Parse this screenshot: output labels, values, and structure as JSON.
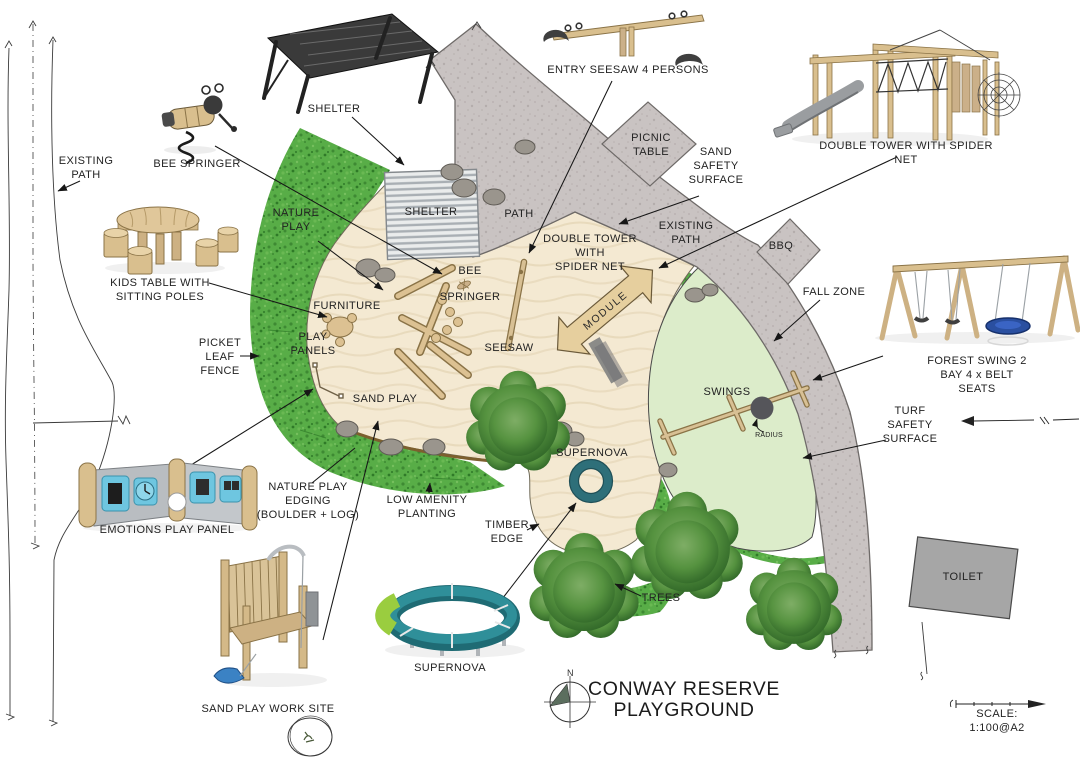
{
  "title": "CONWAY RESERVE\nPLAYGROUND",
  "compass_north": "N",
  "scale_text": "SCALE: 1:100@A2",
  "palette": {
    "sand": "#f4e9d2",
    "path_grey": "#c9c3c2",
    "turf_green": "#dcecca",
    "planting_green": "#58ad47",
    "timber_tan": "#dcc192",
    "supernova_teal": "#2e6f79",
    "toilet_grey": "#a6a6a6",
    "leader_black": "#161616"
  },
  "labels": {
    "existing_path_left": "EXISTING\nPATH",
    "bee_springer_legend": "BEE SPRINGER",
    "shelter_legend": "SHELTER",
    "entry_seesaw": "ENTRY SEESAW 4 PERSONS",
    "picnic_table": "PICNIC\nTABLE",
    "sand_safety_surface": "SAND\nSAFETY\nSURFACE",
    "double_tower_legend": "DOUBLE TOWER WITH SPIDER NET",
    "nature_play": "NATURE\nPLAY",
    "shelter_plan": "SHELTER",
    "path_plan": "PATH",
    "double_tower_plan": "DOUBLE TOWER\nWITH\nSPIDER NET",
    "existing_path_plan": "EXISTING\nPATH",
    "bbq": "BBQ",
    "fall_zone": "FALL ZONE",
    "forest_swing_legend": "FOREST SWING 2 BAY 4 x BELT SEATS",
    "kids_table_legend": "KIDS TABLE WITH\nSITTING POLES",
    "furniture": "FURNITURE",
    "play_panels": "PLAY\nPANELS",
    "picket_leaf_fence": "PICKET\nLEAF\nFENCE",
    "bee_springer_plan": "BEE\nSPRINGER",
    "seesaw": "SEESAW",
    "module": "MODULE",
    "swings": "SWINGS",
    "radius": "RADIUS",
    "sand_play": "SAND PLAY",
    "turf_safety_surface": "TURF\nSAFETY\nSURFACE",
    "nature_play_edging": "NATURE PLAY\nEDGING\n(BOULDER + LOG)",
    "low_amenity_planting": "LOW AMENITY\nPLANTING",
    "supernova_plan": "SUPERNOVA",
    "timber_edge": "TIMBER\nEDGE",
    "emotions_play_panel": "EMOTIONS PLAY PANEL",
    "sand_play_work_site": "SAND PLAY WORK SITE",
    "supernova_legend": "SUPERNOVA",
    "trees": "TREES",
    "toilet": "TOILET"
  }
}
